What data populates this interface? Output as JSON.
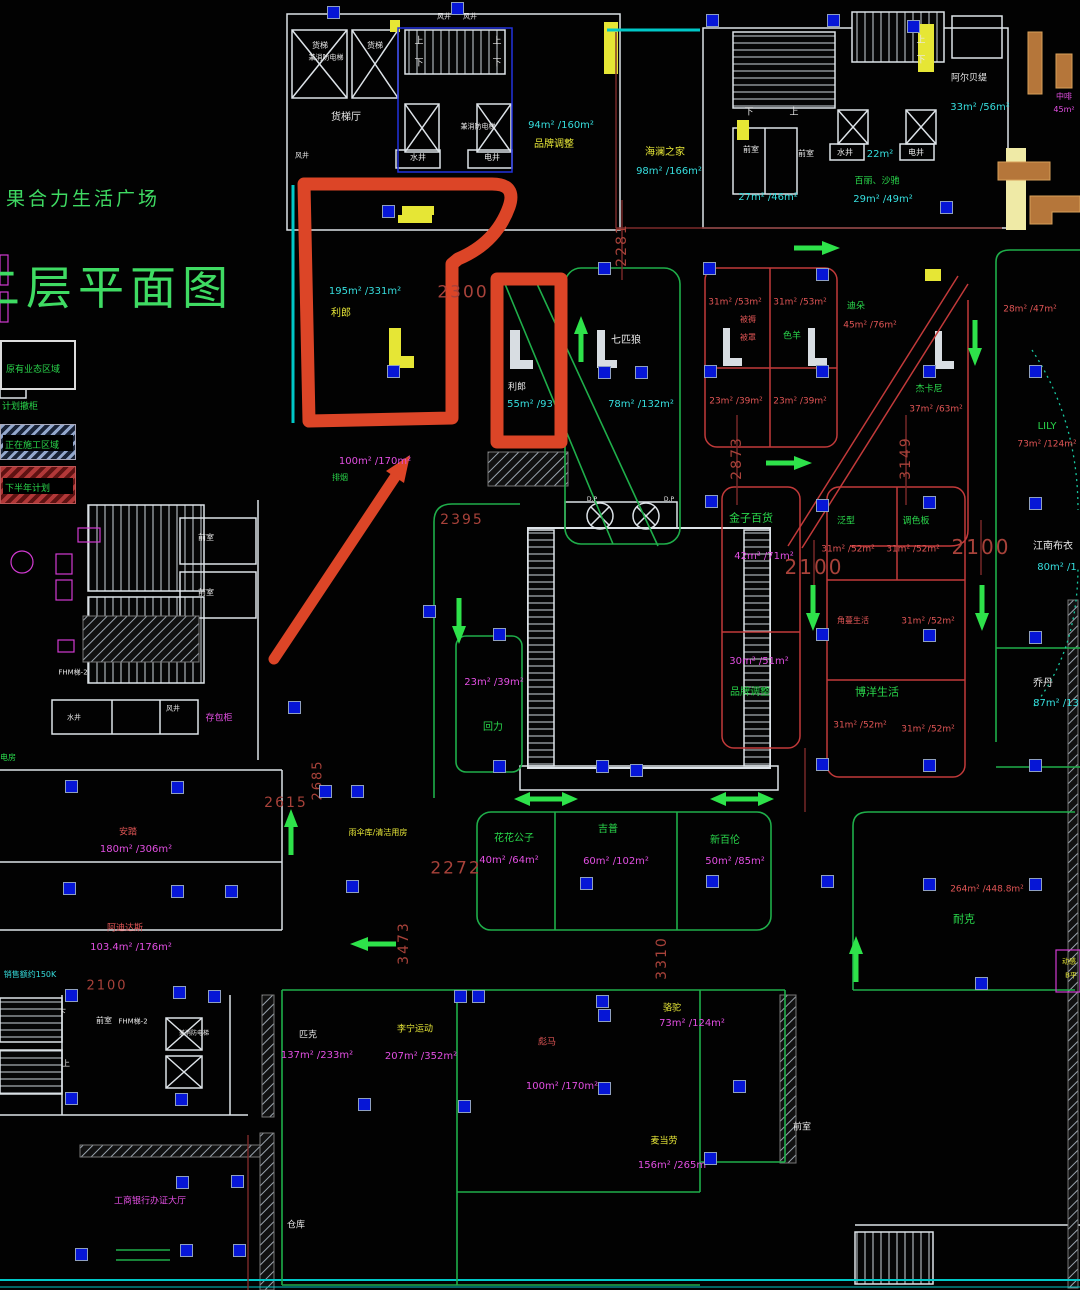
{
  "title": {
    "project": "果合力生活广场",
    "sheet": "二层平面图"
  },
  "legend": {
    "items": [
      {
        "label": "原有业态区域",
        "style": "outlined"
      },
      {
        "label": "计划撤柜",
        "style": "text"
      },
      {
        "label": "正在施工区域",
        "style": "hatch-blue"
      },
      {
        "label": "下半年计划",
        "style": "hatch-red"
      }
    ]
  },
  "colors": {
    "wall": "#dde3e8",
    "room_line": "#1fae4a",
    "shop_line": "#c23a3a",
    "corridor_line": "#7d2a2a",
    "dimension": "#a8423a",
    "highlight": "#dc4527",
    "fixture_blue": "#0616d6",
    "arrow_green": "#2ee24a"
  },
  "labels": [
    [
      "货梯",
      320,
      46,
      "w",
      8
    ],
    [
      "兼消防电梯",
      326,
      58,
      "w",
      7
    ],
    [
      "货梯",
      375,
      46,
      "w",
      8
    ],
    [
      "货梯厅",
      346,
      118,
      "w",
      10
    ],
    [
      "风井",
      302,
      156,
      "w",
      7
    ],
    [
      "风井",
      444,
      17,
      "w",
      7
    ],
    [
      "风井",
      470,
      17,
      "w",
      7
    ],
    [
      "水井",
      418,
      158,
      "w",
      8
    ],
    [
      "电井",
      492,
      158,
      "w",
      8
    ],
    [
      "兼消防电梯",
      478,
      127,
      "w",
      7
    ],
    [
      "上",
      419,
      42,
      "w",
      9
    ],
    [
      "下",
      419,
      64,
      "w",
      9
    ],
    [
      "上",
      497,
      42,
      "w",
      9
    ],
    [
      "下",
      497,
      64,
      "w",
      9
    ],
    [
      "下",
      749,
      113,
      "w",
      9
    ],
    [
      "上",
      794,
      113,
      "w",
      9
    ],
    [
      "上",
      921,
      41,
      "w",
      9
    ],
    [
      "下",
      921,
      61,
      "w",
      9
    ],
    [
      "前室",
      751,
      150,
      "w",
      8
    ],
    [
      "前室",
      806,
      154,
      "w",
      8
    ],
    [
      "水井",
      845,
      153,
      "w",
      8
    ],
    [
      "电井",
      916,
      153,
      "w",
      8
    ],
    [
      "阿尔贝缇",
      969,
      79,
      "w",
      9
    ],
    [
      "利郎",
      517,
      388,
      "w",
      9
    ],
    [
      "七匹狼",
      626,
      341,
      "w",
      10
    ],
    [
      "江南布衣",
      1053,
      547,
      "w",
      10
    ],
    [
      "乔丹",
      1043,
      684,
      "w",
      10
    ],
    [
      "前室",
      206,
      538,
      "w",
      8
    ],
    [
      "前室",
      206,
      593,
      "w",
      8
    ],
    [
      "FHM梯-2",
      73,
      673,
      "w",
      7
    ],
    [
      "FHM梯-2",
      133,
      1022,
      "w",
      7
    ],
    [
      "水井",
      74,
      718,
      "w",
      7
    ],
    [
      "风井",
      173,
      709,
      "w",
      7
    ],
    [
      "匹克",
      308,
      1036,
      "w",
      9
    ],
    [
      "前室",
      104,
      1021,
      "w",
      8
    ],
    [
      "前室",
      802,
      1128,
      "w",
      9
    ],
    [
      "兼消防电梯",
      194,
      1034,
      "w",
      6
    ],
    [
      "仓库",
      296,
      1226,
      "w",
      9
    ],
    [
      "D.P",
      592,
      500,
      "w",
      6
    ],
    [
      "D.P",
      669,
      500,
      "w",
      6
    ],
    [
      "下",
      62,
      1013,
      "w",
      8
    ],
    [
      "上",
      66,
      1064,
      "w",
      8
    ],
    [
      "品牌调整",
      554,
      145,
      "y",
      10
    ],
    [
      "海澜之家",
      665,
      153,
      "y",
      10
    ],
    [
      "利郎",
      341,
      314,
      "y",
      10
    ],
    [
      "李宁运动",
      415,
      1030,
      "y",
      9
    ],
    [
      "骆驼",
      672,
      1009,
      "y",
      9
    ],
    [
      "麦当劳",
      664,
      1142,
      "y",
      9
    ],
    [
      "雨伞库/清洁用房",
      378,
      833,
      "y",
      8
    ],
    [
      "动感",
      1069,
      962,
      "y",
      7
    ],
    [
      "B平",
      1071,
      976,
      "y",
      7
    ],
    [
      "色羊",
      792,
      337,
      "g",
      9
    ],
    [
      "迪朵",
      856,
      307,
      "g",
      9
    ],
    [
      "杰卡尼",
      929,
      390,
      "g",
      9
    ],
    [
      "LILY",
      1047,
      427,
      "g",
      10
    ],
    [
      "金子百货",
      751,
      518,
      "g",
      11
    ],
    [
      "泛型",
      846,
      522,
      "g",
      9
    ],
    [
      "调色板",
      916,
      522,
      "g",
      9
    ],
    [
      "博洋生活",
      877,
      692,
      "g",
      11
    ],
    [
      "品牌调整",
      750,
      693,
      "g",
      10
    ],
    [
      "回力",
      493,
      728,
      "g",
      10
    ],
    [
      "百丽、沙驰",
      877,
      182,
      "g",
      9
    ],
    [
      "花花公子",
      514,
      839,
      "g",
      10
    ],
    [
      "吉普",
      608,
      830,
      "g",
      10
    ],
    [
      "新百伦",
      725,
      841,
      "g",
      10
    ],
    [
      "耐克",
      964,
      919,
      "g",
      11
    ],
    [
      "排烟",
      340,
      478,
      "g",
      8
    ],
    [
      "电房",
      8,
      758,
      "g",
      8
    ],
    [
      "94m² /160m²",
      561,
      126,
      "c",
      10
    ],
    [
      "98m² /166m²",
      669,
      172,
      "c",
      10
    ],
    [
      "27m² /46m²",
      768,
      198,
      "c",
      10
    ],
    [
      "22m²",
      880,
      155,
      "c",
      10
    ],
    [
      "29m² /49m²",
      883,
      200,
      "c",
      10
    ],
    [
      "33m² /56m²",
      980,
      108,
      "c",
      10
    ],
    [
      "195m² /331m²",
      365,
      292,
      "c",
      10
    ],
    [
      "55m² /93",
      530,
      405,
      "c",
      10
    ],
    [
      "78m² /132m²",
      641,
      405,
      "c",
      10
    ],
    [
      "87m² /13",
      1056,
      704,
      "c",
      10
    ],
    [
      "80m² /1",
      1057,
      568,
      "c",
      10
    ],
    [
      "销售额约150K",
      30,
      975,
      "c",
      8
    ],
    [
      "100m² /170m²",
      375,
      462,
      "m",
      10
    ],
    [
      "中啡",
      1064,
      97,
      "m",
      8
    ],
    [
      "45m²",
      1064,
      110,
      "m",
      8
    ],
    [
      "42m² /71m²",
      764,
      557,
      "m",
      10
    ],
    [
      "23m² /39m²",
      494,
      683,
      "m",
      10
    ],
    [
      "30m² /51m²",
      759,
      662,
      "m",
      10
    ],
    [
      "180m² /306m²",
      136,
      850,
      "m",
      10
    ],
    [
      "103.4m² /176m²",
      131,
      948,
      "m",
      10
    ],
    [
      "工商银行办证大厅",
      150,
      1202,
      "m",
      9
    ],
    [
      "存包柜",
      219,
      719,
      "m",
      9
    ],
    [
      "137m² /233m²",
      317,
      1056,
      "m",
      10
    ],
    [
      "207m² /352m²",
      421,
      1057,
      "m",
      10
    ],
    [
      "100m² /170m²",
      562,
      1087,
      "m",
      10
    ],
    [
      "73m² /124m²",
      692,
      1024,
      "m",
      10
    ],
    [
      "156m² /265m²",
      674,
      1166,
      "m",
      10
    ],
    [
      "40m² /64m²",
      509,
      861,
      "m",
      10
    ],
    [
      "60m² /102m²",
      616,
      862,
      "m",
      10
    ],
    [
      "50m² /85m²",
      735,
      862,
      "m",
      10
    ],
    [
      "31m² /53m²",
      735,
      303,
      "r",
      9
    ],
    [
      "31m² /53m²",
      800,
      303,
      "r",
      9
    ],
    [
      "被褥",
      748,
      320,
      "r",
      8
    ],
    [
      "被罩",
      748,
      338,
      "r",
      8
    ],
    [
      "45m² /76m²",
      870,
      326,
      "r",
      9
    ],
    [
      "23m² /39m²",
      736,
      402,
      "r",
      9
    ],
    [
      "23m² /39m²",
      800,
      402,
      "r",
      9
    ],
    [
      "37m² /63m²",
      936,
      410,
      "r",
      9
    ],
    [
      "28m² /47m²",
      1030,
      310,
      "r",
      9
    ],
    [
      "73m² /124m²",
      1047,
      445,
      "r",
      9
    ],
    [
      "31m² /52m²",
      848,
      550,
      "r",
      9
    ],
    [
      "31m² /52m²",
      913,
      550,
      "r",
      9
    ],
    [
      "角蔓生活",
      853,
      621,
      "r",
      8
    ],
    [
      "31m² /52m²",
      928,
      622,
      "r",
      9
    ],
    [
      "31m² /52m²",
      860,
      726,
      "r",
      9
    ],
    [
      "31m² /52m²",
      928,
      730,
      "r",
      9
    ],
    [
      "264m² /448.8m²",
      987,
      890,
      "r",
      9
    ],
    [
      "安踏",
      128,
      833,
      "r",
      9
    ],
    [
      "阿迪达斯",
      125,
      929,
      "r",
      9
    ],
    [
      "彪马",
      547,
      1043,
      "r",
      9
    ],
    [
      "2300",
      463,
      293,
      "d",
      17
    ],
    [
      "2281",
      622,
      245,
      "d",
      14,
      90
    ],
    [
      "2873",
      737,
      458,
      "d",
      14,
      90
    ],
    [
      "3149",
      906,
      458,
      "d",
      14,
      90
    ],
    [
      "2100",
      981,
      547,
      "d",
      20
    ],
    [
      "2100",
      814,
      567,
      "d",
      20
    ],
    [
      "2395",
      462,
      520,
      "d",
      14
    ],
    [
      "2685",
      318,
      780,
      "d",
      13,
      90
    ],
    [
      "2615",
      286,
      803,
      "d",
      14
    ],
    [
      "2100",
      107,
      986,
      "d",
      13
    ],
    [
      "2272",
      456,
      869,
      "d",
      17
    ],
    [
      "3473",
      404,
      943,
      "d",
      14,
      90
    ],
    [
      "3310",
      662,
      958,
      "d",
      14,
      90
    ]
  ],
  "blue_squares": [
    [
      333,
      12
    ],
    [
      457,
      8
    ],
    [
      712,
      20
    ],
    [
      833,
      20
    ],
    [
      913,
      26
    ],
    [
      946,
      207
    ],
    [
      388,
      211
    ],
    [
      604,
      268
    ],
    [
      604,
      372
    ],
    [
      393,
      371
    ],
    [
      641,
      372
    ],
    [
      709,
      268
    ],
    [
      822,
      274
    ],
    [
      710,
      371
    ],
    [
      822,
      371
    ],
    [
      929,
      371
    ],
    [
      1035,
      371
    ],
    [
      711,
      501
    ],
    [
      822,
      505
    ],
    [
      929,
      502
    ],
    [
      1035,
      503
    ],
    [
      822,
      634
    ],
    [
      929,
      635
    ],
    [
      1035,
      637
    ],
    [
      822,
      764
    ],
    [
      929,
      765
    ],
    [
      1035,
      765
    ],
    [
      499,
      634
    ],
    [
      499,
      766
    ],
    [
      602,
      766
    ],
    [
      636,
      770
    ],
    [
      294,
      707
    ],
    [
      429,
      611
    ],
    [
      71,
      786
    ],
    [
      177,
      787
    ],
    [
      69,
      888
    ],
    [
      177,
      891
    ],
    [
      231,
      891
    ],
    [
      325,
      791
    ],
    [
      357,
      791
    ],
    [
      352,
      886
    ],
    [
      586,
      883
    ],
    [
      712,
      881
    ],
    [
      827,
      881
    ],
    [
      929,
      884
    ],
    [
      1035,
      884
    ],
    [
      981,
      983
    ],
    [
      460,
      996
    ],
    [
      478,
      996
    ],
    [
      364,
      1104
    ],
    [
      464,
      1106
    ],
    [
      602,
      1001
    ],
    [
      604,
      1015
    ],
    [
      604,
      1088
    ],
    [
      739,
      1086
    ],
    [
      710,
      1158
    ],
    [
      71,
      995
    ],
    [
      179,
      992
    ],
    [
      214,
      996
    ],
    [
      71,
      1098
    ],
    [
      181,
      1099
    ],
    [
      182,
      1182
    ],
    [
      237,
      1181
    ],
    [
      81,
      1254
    ],
    [
      186,
      1250
    ],
    [
      239,
      1250
    ]
  ],
  "arrows": [
    [
      "r",
      816,
      248
    ],
    [
      "r",
      788,
      463
    ],
    [
      "l",
      374,
      944
    ],
    [
      "u",
      581,
      340
    ],
    [
      "u",
      291,
      833
    ],
    [
      "u",
      856,
      960
    ],
    [
      "d",
      975,
      342
    ],
    [
      "d",
      459,
      620
    ],
    [
      "d",
      813,
      607
    ],
    [
      "d",
      982,
      607
    ],
    [
      "h",
      546,
      799
    ],
    [
      "h",
      742,
      799
    ]
  ]
}
